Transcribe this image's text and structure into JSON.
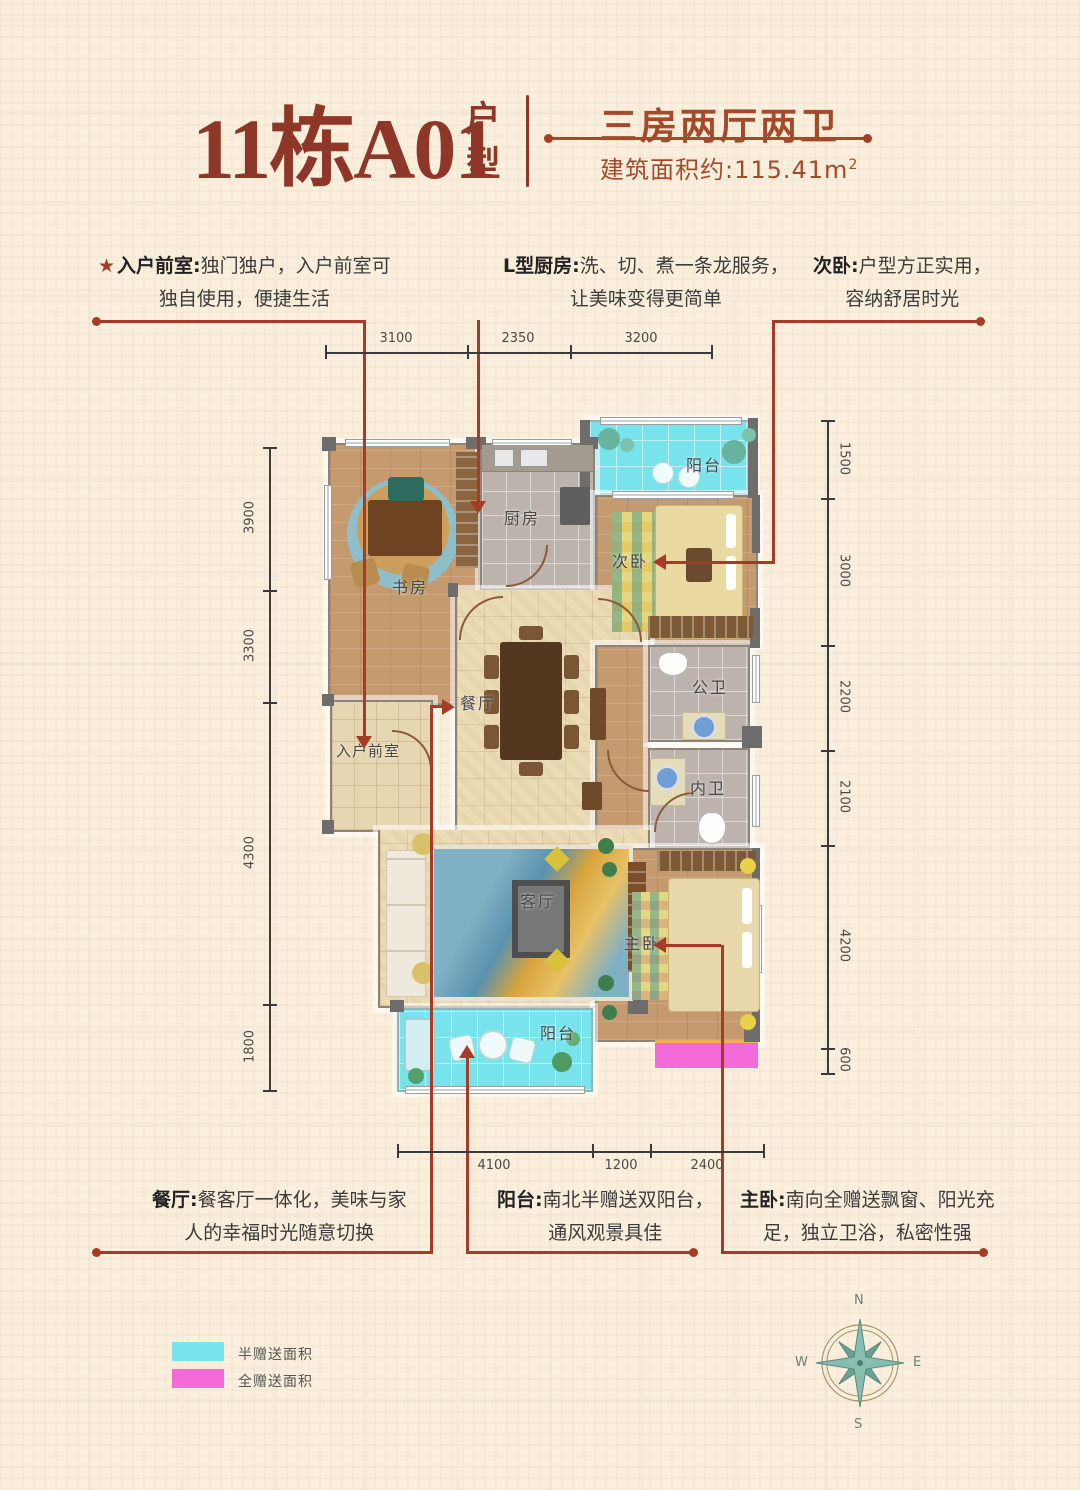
{
  "header": {
    "title": "11栋A01",
    "title_suffix": "户型",
    "type_title": "三房两厅两卫",
    "area_label": "建筑面积约:115.41m",
    "area_sup": "2"
  },
  "ann": {
    "foyer": {
      "star": "★",
      "b": "入户前室:",
      "t1": "独门独户，入户前室可",
      "t2": "独自使用，便捷生活"
    },
    "kitchen": {
      "b": "L型厨房:",
      "t1": "洗、切、煮一条龙服务，",
      "t2": "让美味变得更简单"
    },
    "bedroom2": {
      "b": "次卧:",
      "t1": "户型方正实用，",
      "t2": "容纳舒居时光"
    },
    "dining": {
      "b": "餐厅:",
      "t1": "餐客厅一体化，美味与家",
      "t2": "人的幸福时光随意切换"
    },
    "balcony": {
      "b": "阳台:",
      "t1": "南北半赠送双阳台，",
      "t2": "通风观景具佳"
    },
    "master": {
      "b": "主卧:",
      "t1": "南向全赠送飘窗、阳光充",
      "t2": "足，独立卫浴，私密性强"
    }
  },
  "rooms": {
    "study": "书房",
    "kitchen": "厨房",
    "balcony_top": "阳台",
    "bedroom2": "次卧",
    "bath_public": "公卫",
    "bath_private": "内卫",
    "dining": "餐厅",
    "foyer": "入户前室",
    "living": "客厅",
    "master": "主卧",
    "balcony_bottom": "阳台"
  },
  "dims": {
    "top": [
      "3100",
      "2350",
      "3200"
    ],
    "left": [
      "3900",
      "3300",
      "4300",
      "1800"
    ],
    "right": [
      "1500",
      "3000",
      "2200",
      "2100",
      "4200",
      "600"
    ],
    "bottom": [
      "4100",
      "1200",
      "2400"
    ]
  },
  "legend": {
    "items": [
      {
        "label": "半赠送面积",
        "color": "#79e3ec"
      },
      {
        "label": "全赠送面积",
        "color": "#f26bd8"
      }
    ]
  },
  "compass": {
    "n": "N",
    "e": "E",
    "s": "S",
    "w": "W"
  },
  "colors": {
    "accent_red": "#a63c28",
    "title_red": "#8e3728",
    "subtitle_red": "#a34a2c",
    "half_gift_cyan": "#79e3ec",
    "full_gift_magenta": "#f26bd8",
    "background_cream": "#f9efdc"
  }
}
